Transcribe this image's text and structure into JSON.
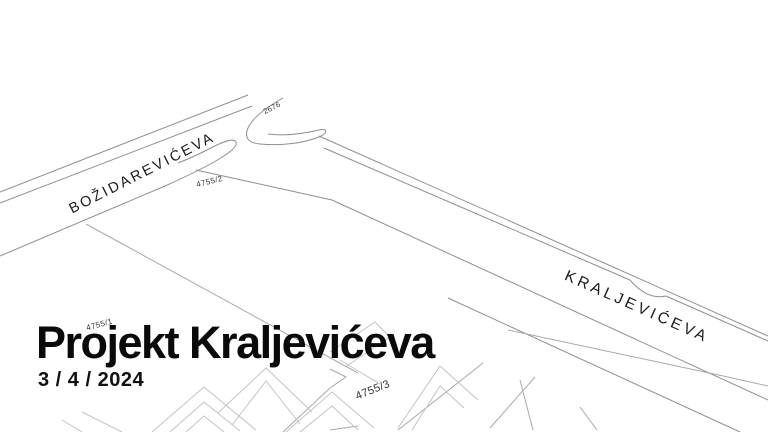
{
  "document": {
    "title": "Projekt Kraljevićeva",
    "date": "3 / 4 / 2024"
  },
  "map": {
    "streets": [
      {
        "name": "BOŽIDAREVIĆEVA"
      },
      {
        "name": "KRALJEVIĆEVA"
      }
    ],
    "parcels": [
      {
        "id": "2676"
      },
      {
        "id": "4755/2"
      },
      {
        "id": "4755/1"
      },
      {
        "id": "4755/3"
      }
    ],
    "colors": {
      "background": "#ffffff",
      "street_line": "#8f8f8f",
      "parcel_line": "#a9a9a9",
      "building_line": "#c3c3c3",
      "label_text": "#1b1b1b",
      "title_text": "#0a0a0a"
    }
  }
}
